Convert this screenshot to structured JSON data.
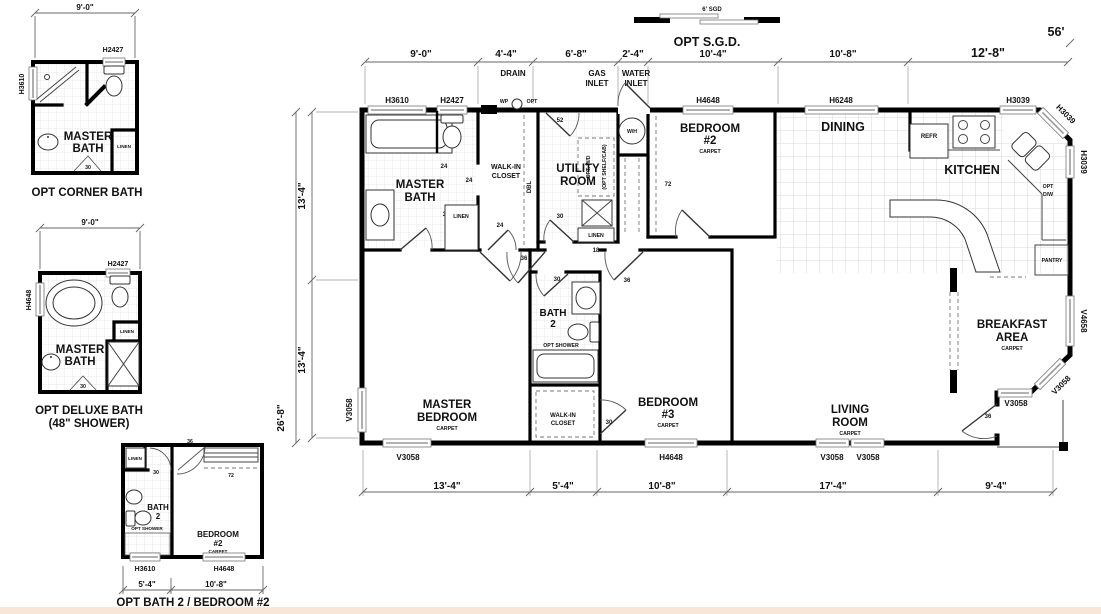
{
  "drawing": {
    "captions": {
      "corner_bath": "OPT CORNER BATH",
      "deluxe_bath": "OPT DELUXE BATH",
      "deluxe_bath_sub": "(48\" SHOWER)",
      "bath2_bedroom2": "OPT BATH 2 / BEDROOM #2",
      "opt_sgd": "OPT S.G.D.",
      "sgd_size": "6' SGD"
    },
    "rooms": {
      "master_bath_l1": "MASTER",
      "master_bath_l2": "BATH",
      "walkin_l1": "WALK-IN",
      "walkin_l2": "CLOSET",
      "utility_l1": "UTILITY",
      "utility_l2": "ROOM",
      "bedroom2_l1": "BEDROOM",
      "bedroom2_l2": "#2",
      "bedroom3_l1": "BEDROOM",
      "bedroom3_l2": "#3",
      "dining": "DINING",
      "kitchen": "KITCHEN",
      "breakfast_l1": "BREAKFAST",
      "breakfast_l2": "AREA",
      "living_l1": "LIVING",
      "living_l2": "ROOM",
      "master_bedroom_l1": "MASTER",
      "master_bedroom_l2": "BEDROOM",
      "bath2_l1": "BATH",
      "bath2_l2": "2",
      "carpet": "CARPET",
      "pantry": "PANTRY",
      "linen": "LINEN"
    },
    "fixtures": {
      "refr": "REFR",
      "wh": "W/H",
      "opt_dw_l1": "OPT",
      "opt_dw_l2": "D/W",
      "opt_wd": "OPT. W/D",
      "opt_shelf_cab": "(OPT SHELF/CAB)",
      "dbl": "DBL",
      "opt_shower": "OPT SHOWER",
      "wp": "WP",
      "opt": "OPT"
    },
    "site": {
      "drain": "DRAIN",
      "gas_l1": "GAS",
      "gas_l2": "INLET",
      "water_l1": "WATER",
      "water_l2": "INLET"
    },
    "windows": {
      "h3610": "H3610",
      "h2427": "H2427",
      "h4648": "H4648",
      "h6248": "H6248",
      "h3039": "H3039",
      "v3058": "V3058",
      "v4658": "V4658"
    },
    "doors": {
      "d18": "18",
      "d24": "24",
      "d30": "30",
      "d36": "36",
      "d52": "52",
      "d72": "72"
    },
    "dims": {
      "d9_0": "9'-0\"",
      "d4_4": "4'-4\"",
      "d6_8": "6'-8\"",
      "d2_4": "2'-4\"",
      "d10_4": "10'-4\"",
      "d10_8": "10'-8\"",
      "d12_8": "12'-8\"",
      "d56": "56'",
      "d13_4": "13'-4\"",
      "d26_8": "26'-8\"",
      "d5_4": "5'-4\"",
      "d17_4": "17'-4\"",
      "d9_4": "9'-4\""
    }
  }
}
